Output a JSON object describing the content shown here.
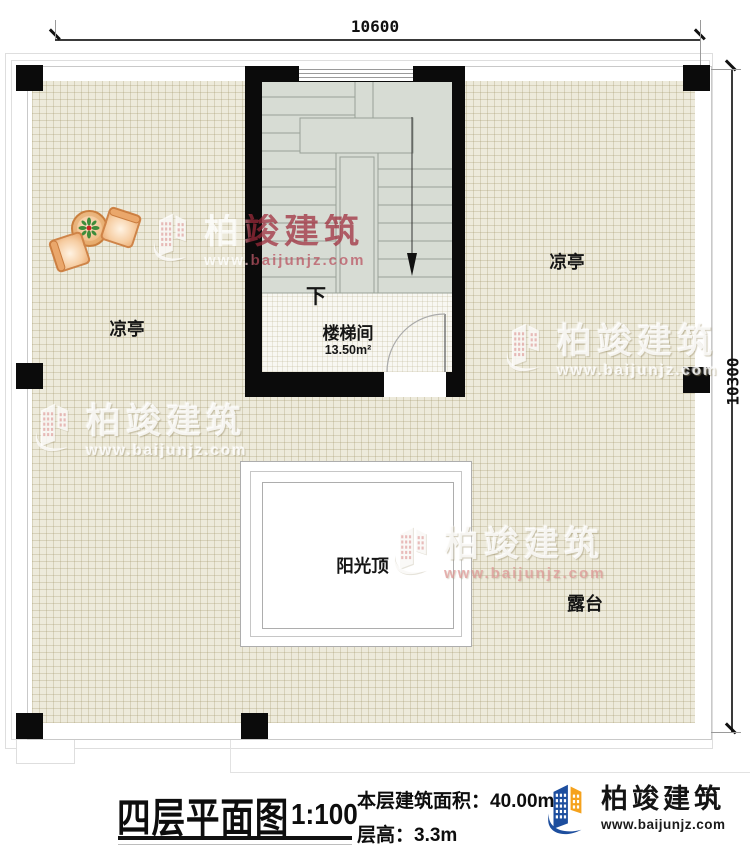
{
  "dimensions": {
    "top": "10600",
    "right": "10300"
  },
  "rooms": {
    "stairwell": {
      "name": "楼梯间",
      "area": "13.50m²",
      "direction": "下"
    },
    "pavilion_left": {
      "name": "凉亭"
    },
    "pavilion_right": {
      "name": "凉亭"
    },
    "sunroof": {
      "name": "阳光顶"
    },
    "terrace": {
      "name": "露台"
    }
  },
  "watermark": {
    "brand": "柏竣建筑",
    "url": "www.baijunjz.com"
  },
  "title_block": {
    "title": "四层平面图",
    "scale": "1:100",
    "area_label": "本层建筑面积：",
    "area_value": "40.00m²",
    "floor_height_label": "层高：",
    "floor_height_value": "3.3m"
  },
  "logo": {
    "brand": "柏竣建筑",
    "url": "www.baijunjz.com"
  },
  "colors": {
    "wall": "#0b0b0b",
    "floor_tile": "#edeadb",
    "stair_floor": "#d7dcd4",
    "logo_blue": "#1d4e9e",
    "logo_orange": "#f5a21d",
    "watermark_red": "#9e2a3a"
  }
}
